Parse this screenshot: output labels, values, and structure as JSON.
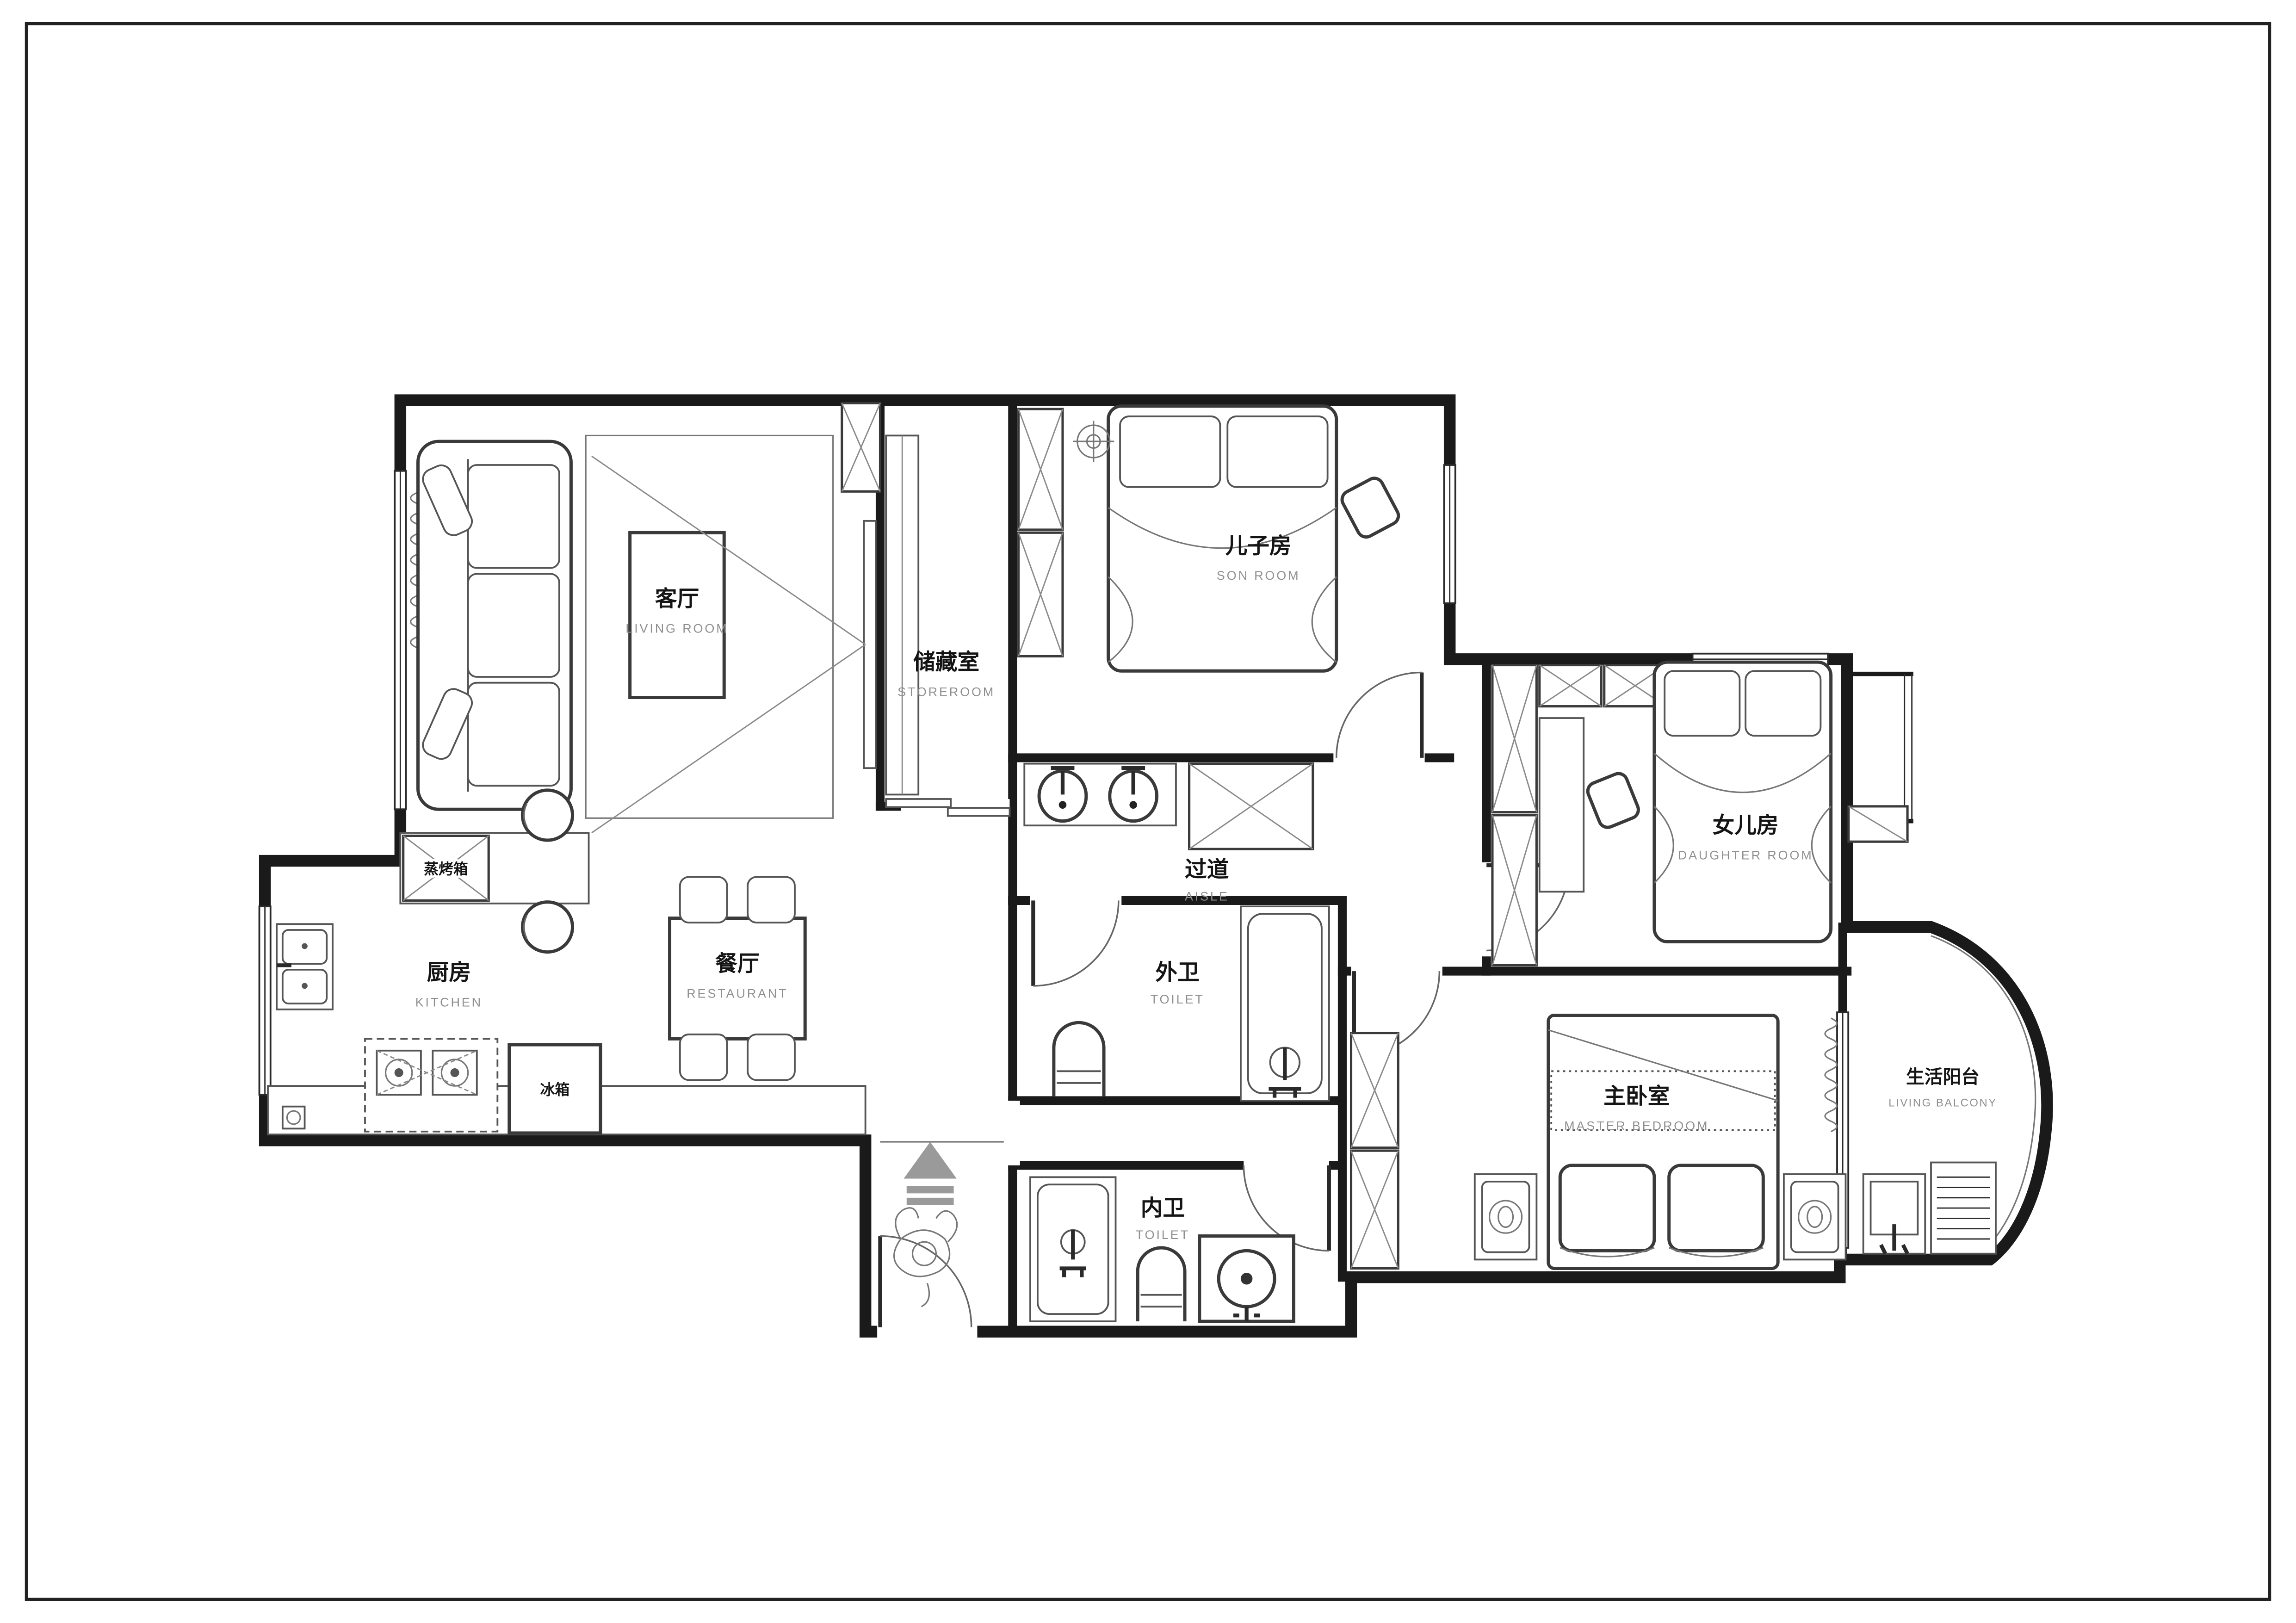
{
  "drawing": {
    "kind": "residential floor plan",
    "background": "#ffffff",
    "wall_color": "#1a1a1a",
    "secondary_text_color": "#8f8f8f"
  },
  "rooms": [
    {
      "id": "living",
      "zh": "客厅",
      "en": "LIVING ROOM"
    },
    {
      "id": "storeroom",
      "zh": "储藏室",
      "en": "STOREROOM"
    },
    {
      "id": "son",
      "zh": "儿子房",
      "en": "SON ROOM"
    },
    {
      "id": "daughter",
      "zh": "女儿房",
      "en": "DAUGHTER ROOM"
    },
    {
      "id": "aisle",
      "zh": "过道",
      "en": "AISLE"
    },
    {
      "id": "kitchen",
      "zh": "厨房",
      "en": "KITCHEN"
    },
    {
      "id": "restaurant",
      "zh": "餐厅",
      "en": "RESTAURANT"
    },
    {
      "id": "toilet_outer",
      "zh": "外卫",
      "en": "TOILET"
    },
    {
      "id": "toilet_inner",
      "zh": "内卫",
      "en": "TOILET"
    },
    {
      "id": "master",
      "zh": "主卧室",
      "en": "MASTER BEDROOM"
    },
    {
      "id": "balcony",
      "zh": "生活阳台",
      "en": "LIVING BALCONY"
    }
  ],
  "appliances": [
    {
      "id": "steam_oven",
      "zh": "蒸烤箱"
    },
    {
      "id": "fridge",
      "zh": "冰箱"
    }
  ]
}
